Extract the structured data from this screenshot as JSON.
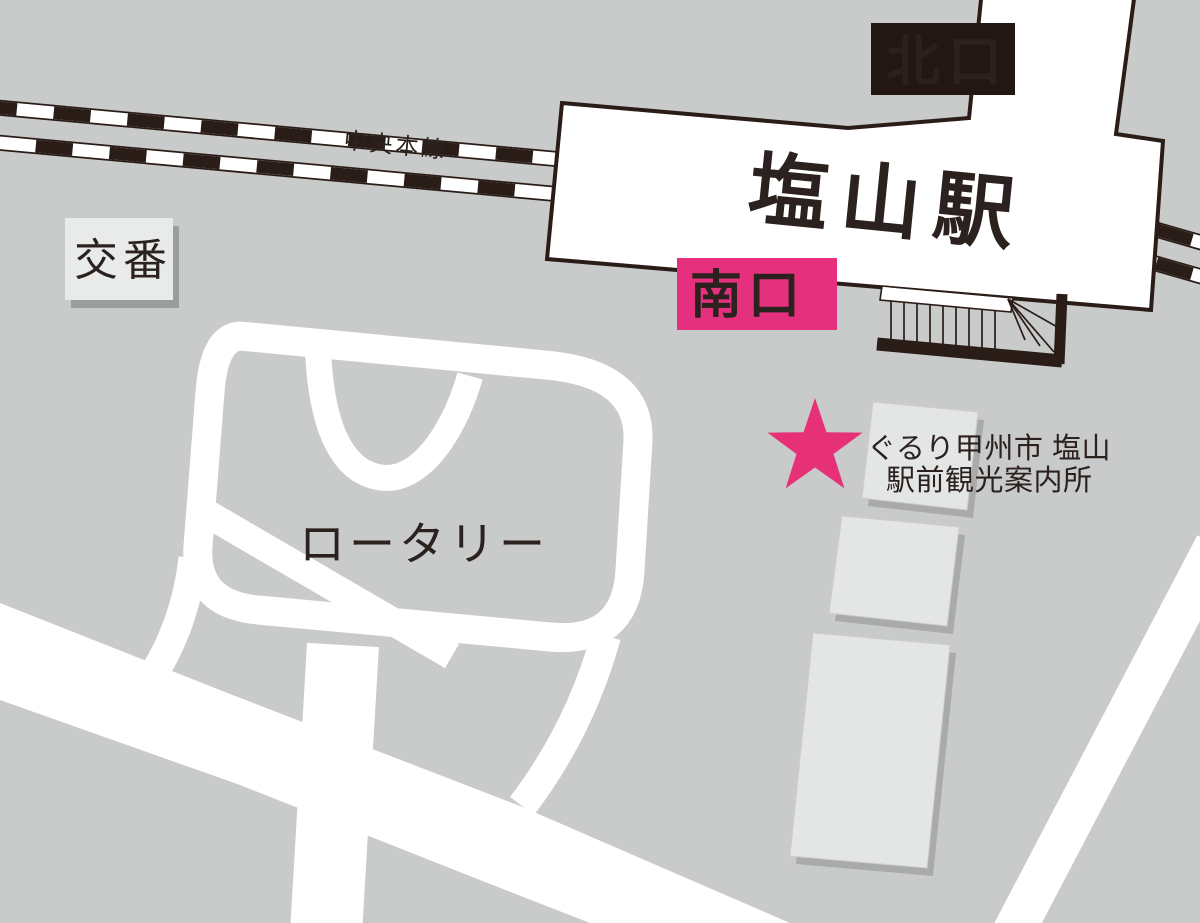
{
  "map": {
    "colors": {
      "background": "#c9caca",
      "road": "#ffffff",
      "dark_line": "#2a1d18",
      "north_exit_bg": "#221713",
      "south_exit_bg": "#e5317d",
      "star_pink": "#e73177",
      "building": "#e4e5e5",
      "building_shadow": "#a9aaaa",
      "police_box_fill": "#e9eaea",
      "police_box_shadow": "#9c9d9d",
      "label_text": "#2b211e",
      "exit_label_text": "#ffffff"
    },
    "station": {
      "name": "塩山駅",
      "north_exit": "北口",
      "south_exit": "南口"
    },
    "railway": {
      "name": "中央本線"
    },
    "police_box": {
      "label": "交番"
    },
    "rotary": {
      "label": "ロータリー"
    },
    "info_center": {
      "line1": "ぐるり甲州市 塩山",
      "line2": "駅前観光案内所"
    }
  }
}
